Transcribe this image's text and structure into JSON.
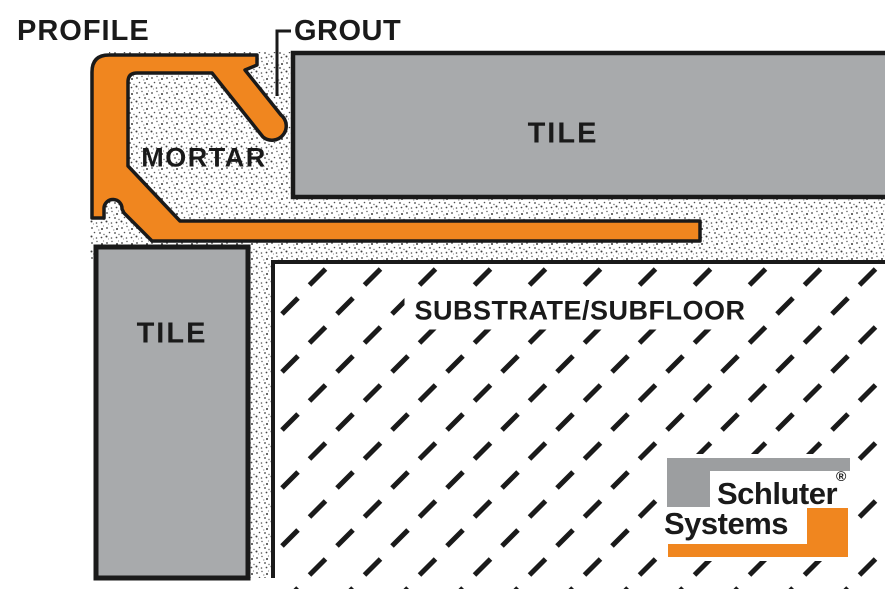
{
  "diagram": {
    "title": "Tile edge profile installation cross-section",
    "labels": {
      "profile": "PROFILE",
      "grout": "GROUT",
      "mortar": "MORTAR",
      "tile_top": "TILE",
      "tile_left": "TILE",
      "substrate": "SUBSTRATE/SUBFLOOR"
    },
    "logo": {
      "line1": "Schluter",
      "registered": "®",
      "line2": "Systems"
    },
    "colors": {
      "profile_orange": "#F0861F",
      "tile_gray": "#A8AAAC",
      "logo_gray": "#9C9EA0",
      "logo_orange": "#F0861F",
      "outline_ink": "#1A1A1A",
      "background": "#FFFFFF"
    }
  }
}
